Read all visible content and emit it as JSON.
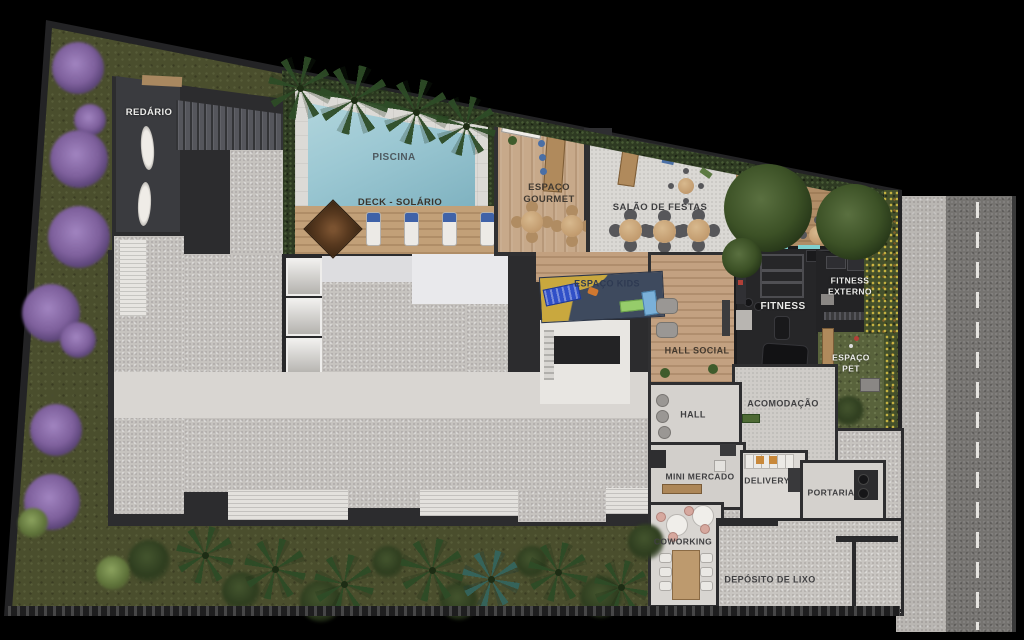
{
  "plan": {
    "title": "Ground floor / leisure area plan",
    "areas": {
      "redario": "REDÁRIO",
      "piscina": "PISCINA",
      "deck_solario": "DECK - SOLÁRIO",
      "espaco_gourmet": "ESPAÇO GOURMET",
      "salao_de_festas": "SALÃO DE FESTAS",
      "espaco_kids": "ESPAÇO KIDS",
      "hall_social": "HALL SOCIAL",
      "fitness": "FITNESS",
      "fitness_externo": "FITNESS EXTERNO",
      "espaco_pet": "ESPAÇO PET",
      "acomodacao": "ACOMODAÇÃO",
      "hall": "HALL",
      "mini_mercado": "MINI MERCADO",
      "delivery": "DELIVERY",
      "portaria": "PORTARIA",
      "coworking": "COWORKING",
      "deposito_de_lixo": "DEPÓSITO DE LIXO"
    },
    "colors": {
      "background": "#000000",
      "grass": "#4A4E2D",
      "pool_water": "#9CC8D3",
      "wood_deck": "#C8A57C",
      "concrete_roof": "#C6C3BF",
      "charcoal_walls": "#2C2C2E",
      "kids_mat_yellow": "#C9A83E",
      "kids_mat_navy": "#3E4A5E",
      "purple_trees": "#8B6FAB",
      "yellow_flower_hedge": "#D4BD45",
      "road_asphalt": "#757370",
      "sidewalk": "#B9B6B2",
      "lounger_towel_blue": "#3F62A8"
    }
  }
}
